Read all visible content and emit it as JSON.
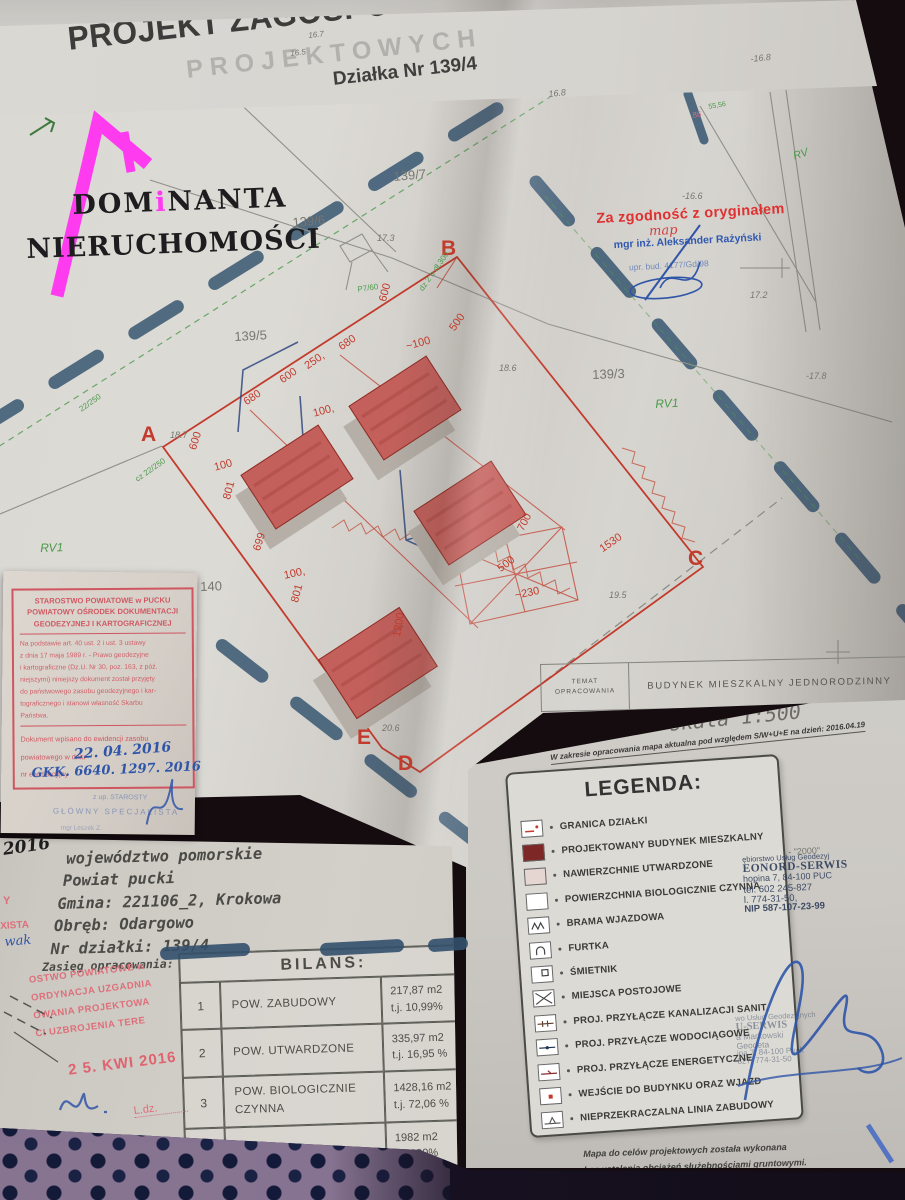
{
  "title_block": {
    "title": "PROJEKT ZAGOSPODAROWANIA TERENU",
    "subtitle": "Działka Nr 139/4",
    "watermark": "PROJEKTOWYCH",
    "parcel_no": "Nr 139/4",
    "hand_note": "136",
    "marks": {
      "m1": "16.5",
      "m2": "16.7",
      "m3": "-16.8",
      "m4": "16.8"
    },
    "soil": "RV"
  },
  "logo": {
    "part1": "DOM",
    "part2": "i",
    "part3": "NANTA",
    "line2": "NIERUCHOMOŚCI",
    "accent": "#ff3bf0"
  },
  "map": {
    "vertices": [
      "A",
      "B",
      "C",
      "D",
      "E"
    ],
    "plots": [
      "139/7",
      "139/6",
      "139/5",
      "139/3",
      "140"
    ],
    "soil": [
      "RV1",
      "RV1",
      "RV"
    ],
    "elevations": [
      "-16.6",
      "17.3",
      "18.7",
      "18.6",
      "-17.8",
      "19.5",
      "20.6",
      "17.2"
    ],
    "dimensions": [
      "600",
      "500",
      "~100",
      "680",
      "250,",
      "600",
      "680",
      "600",
      "100,",
      "100",
      "801",
      "699",
      "100,",
      "801",
      "700",
      "500",
      "~230",
      "1530",
      "1200"
    ],
    "green_notes": [
      "dz 2 o dł.300",
      "P7/60",
      "cz 22/250",
      "22/250"
    ],
    "tiny_marks": [
      "86",
      "55,56"
    ],
    "cert_stamp": {
      "line1": "Za zgodność z oryginałem",
      "scribble": "map",
      "line2": "mgr inż. Aleksander Rażyński",
      "line3": "upr. bud. 4177/Gd/98"
    },
    "temat": {
      "l1": "TEMAT",
      "l2": "OPRACOWANIA",
      "value": "BUDYNEK MIESZKALNY JEDNORODZINNY"
    }
  },
  "left_stamp": {
    "h1": "STAROSTWO POWIATOWE w PUCKU",
    "h2": "POWIATOWY OŚRODEK DOKUMENTACJI",
    "h3": "GEODEZYJNEJ I KARTOGRAFICZNEJ",
    "b1": "Na podstawie art. 40 ust. 2 i ust. 3 ustawy",
    "b2": "z dnia 17 maja 1989 r. - Prawo geodezyjne",
    "b3": "i kartograficzne (Dz.U. Nr 30, poz. 163, z póź.",
    "b4": "niejszymi) niniejszy dokument został przyjęty",
    "b5": "do państwowego zasobu geodezyjnego i kar-",
    "b6": "tograficznego i stanowi własność Skarbu",
    "b7": "Państwa.",
    "f1": "Dokument wpisano do ewidencji zasobu",
    "f2": "powiatowego w dniu",
    "f3": "nr ewidencyjny",
    "date": "22. 04. 2016",
    "number": "GKK. 6640. 1297. 2016",
    "blue1": "z up. STAROSTY",
    "blue2": "GŁÓWNY SPECJALISTA",
    "blue3": "mgr Leszek Z."
  },
  "mapa_sheet": {
    "header": "MAPA DO",
    "scale": "skala 1:500",
    "note": "W zakresie opracowania mapa aktualna pod względem S/W+U+E na dzień: 2016.04.19",
    "frag": "- \"2000\"",
    "legend": {
      "title": "LEGENDA:",
      "items": [
        {
          "label": "GRANICA DZIAŁKI"
        },
        {
          "label": "PROJEKTOWANY BUDYNEK MIESZKALNY"
        },
        {
          "label": "NAWIERZCHNIE UTWARDZONE"
        },
        {
          "label": "POWIERZCHNIA BIOLOGICZNIE CZYNNA"
        },
        {
          "label": "BRAMA WJAZDOWA"
        },
        {
          "label": "FURTKA"
        },
        {
          "label": "ŚMIETNIK"
        },
        {
          "label": "MIEJSCA POSTOJOWE"
        },
        {
          "label": "PROJ. PRZYŁĄCZE KANALIZACJI SANIT."
        },
        {
          "label": "PROJ. PRZYŁĄCZE WODOCIĄGOWE"
        },
        {
          "label": "PROJ. PRZYŁĄCZE ENERGETYCZNE"
        },
        {
          "label": "WEJŚCIE DO BUDYNKU ORAZ WJAZD"
        },
        {
          "label": "NIEPRZEKRACZALNA LINIA ZABUDOWY"
        }
      ]
    },
    "stamp1": {
      "l1": "ębiorstwo Usług Geodezyj",
      "l2": "EONORD-SERWIS",
      "l3": "hopina 7,    84-100 PUC",
      "l4": "tel.  602 245-827",
      "l5": "l. 774-31-50,",
      "l6": "NIP 587-107-23-99"
    },
    "stamp2": {
      "l1": "wo Usług Geodezyjnych",
      "l2": "U-SERWIS",
      "l3": "a Markowski",
      "l4": "Geodeta",
      "l5": "ina 7,  84-100 Puck",
      "l6": "827, 774-31-50"
    },
    "foot1": "Mapa do celów projektowych została wykonana",
    "foot2": "bez ustalenia obciążeń służebnościami gruntowymi."
  },
  "parcel_info": {
    "l1": "województwo pomorskie",
    "l2": "Powiat pucki",
    "l3": "Gmina: 221106_2, Krokowa",
    "l4": "Obręb: Odargowo",
    "l5": "Nr działki: 139/4",
    "scope": "Zasięg opracowania:"
  },
  "bilans": {
    "title": "BILANS:",
    "rows": [
      {
        "no": "1",
        "name": "POW. ZABUDOWY",
        "v1": "217,87 m2",
        "v2": "t.j.  10,99%"
      },
      {
        "no": "2",
        "name": "POW. UTWARDZONE",
        "v1": "335,97 m2",
        "v2": "t.j.  16,95 %"
      },
      {
        "no": "3",
        "name": "POW. BIOLOGICZNIE CZYNNA",
        "v1": "1428,16 m2",
        "v2": "t.j.  72,06 %"
      }
    ],
    "total": {
      "name": "RAZEM",
      "v1": "1982 m2",
      "v2": "t.j.  100%"
    }
  },
  "pink_stamp": {
    "l1": "OSTWO POWIATOWE w",
    "l2": "ORDYNACJA UZGADNIA",
    "l3": "OWANIA PROJEKTOWA",
    "l4": "CI UZBROJENIA TERE",
    "date": "2 5. KWI  2016",
    "ldz": "L.dz."
  },
  "margin_notes": {
    "hand": "2016",
    "red1": "Y",
    "red2": "XISTA",
    "blue": "wak"
  }
}
